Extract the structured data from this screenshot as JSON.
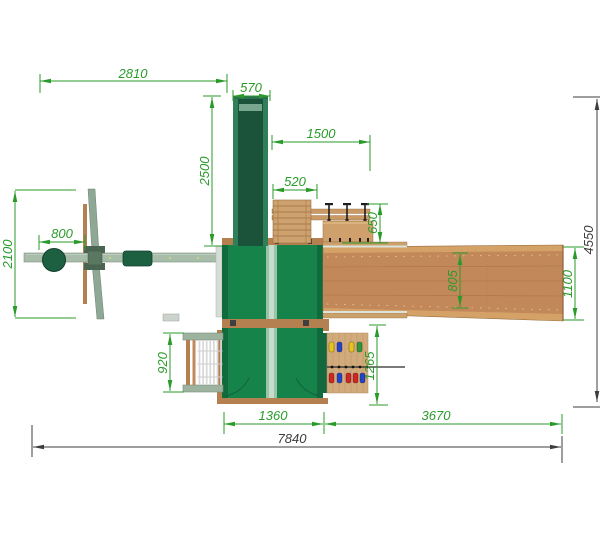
{
  "drawing": {
    "kind": "playground-set-top-view-plan"
  },
  "colors": {
    "dim_green": "#2a9b2a",
    "dim_black": "#3d3d3d",
    "roof_green": "#16834b",
    "roof_edge_green": "#106b3c",
    "ridge_light": "#c6ddcc",
    "slide_green": "#1a5339",
    "slide_rail_green": "#2f7f59",
    "seat_green": "#1c5f41",
    "wood_brown": "#b5804f",
    "ramp_wood": "#c2885a",
    "ladder_wood": "#cda26e",
    "beam_gray": "#a7bca9",
    "net_rail": "#9db3a0"
  },
  "dimensions": [
    {
      "id": "swing-span",
      "value": "2810",
      "orientation": "horizontal"
    },
    {
      "id": "slide-width",
      "value": "570",
      "orientation": "horizontal"
    },
    {
      "id": "slide-length",
      "value": "2500",
      "orientation": "vertical"
    },
    {
      "id": "monkeybar-span",
      "value": "1500",
      "orientation": "horizontal"
    },
    {
      "id": "ladder-width",
      "value": "520",
      "orientation": "horizontal"
    },
    {
      "id": "monkeybar-depth",
      "value": "650",
      "orientation": "vertical"
    },
    {
      "id": "swing-seat-offset",
      "value": "800",
      "orientation": "horizontal"
    },
    {
      "id": "aframe-depth",
      "value": "2100",
      "orientation": "vertical"
    },
    {
      "id": "ramp-width",
      "value": "805",
      "orientation": "vertical"
    },
    {
      "id": "ramp-end-width",
      "value": "1100",
      "orientation": "vertical"
    },
    {
      "id": "overall-depth",
      "value": "4550",
      "orientation": "vertical"
    },
    {
      "id": "net-width",
      "value": "920",
      "orientation": "vertical"
    },
    {
      "id": "climbwall-depth",
      "value": "1265",
      "orientation": "vertical"
    },
    {
      "id": "tower-width",
      "value": "1360",
      "orientation": "horizontal"
    },
    {
      "id": "ramp-span",
      "value": "3670",
      "orientation": "horizontal"
    },
    {
      "id": "overall-length",
      "value": "7840",
      "orientation": "horizontal"
    }
  ]
}
